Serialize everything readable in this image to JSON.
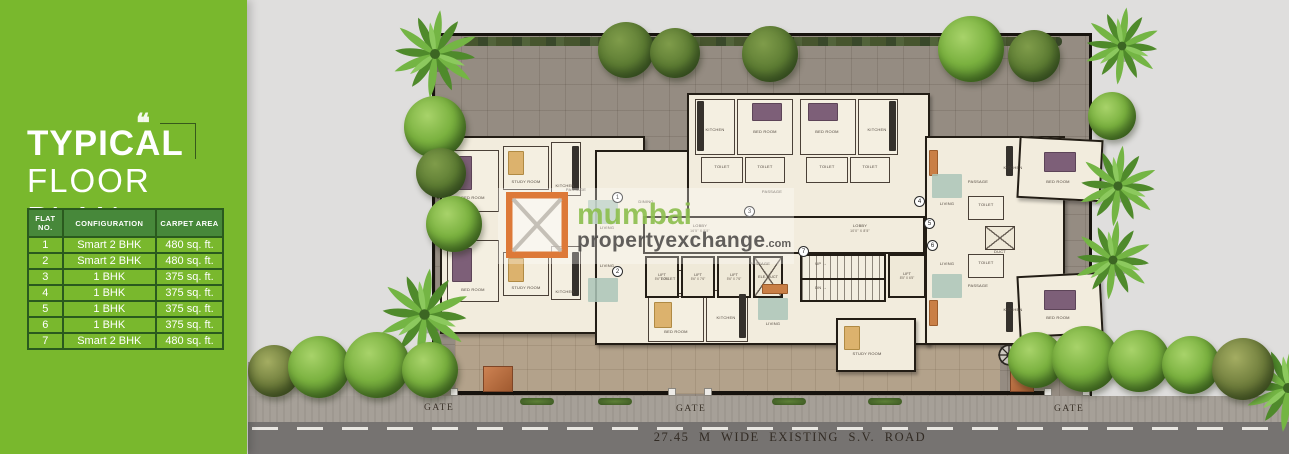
{
  "colors": {
    "panel_green": "#79b82d",
    "table_header_green": "#47883a",
    "table_border_green": "#2a5a1e",
    "watermark_green": "#8cbf4d",
    "watermark_gray": "#514f4c",
    "logo_orange": "#dd7938",
    "paving_gray": "#958c82",
    "plaza_beige": "#b3a28b",
    "road_gray": "#767371"
  },
  "left_panel": {
    "quote_glyph": "❝",
    "title_line1": "TYPICAL",
    "title_line2": "FLOOR PLAN",
    "table": {
      "headers": [
        "FLAT NO.",
        "CONFIGURATION",
        "CARPET AREA"
      ],
      "rows": [
        [
          "1",
          "Smart 2 BHK",
          "480 sq. ft."
        ],
        [
          "2",
          "Smart 2 BHK",
          "480 sq. ft."
        ],
        [
          "3",
          "1 BHK",
          "375 sq. ft."
        ],
        [
          "4",
          "1 BHK",
          "375 sq. ft."
        ],
        [
          "5",
          "1 BHK",
          "375 sq. ft."
        ],
        [
          "6",
          "1 BHK",
          "375 sq. ft."
        ],
        [
          "7",
          "Smart 2 BHK",
          "480 sq. ft."
        ]
      ]
    }
  },
  "watermark": {
    "brand": "mumbai",
    "brand2": "propertyexchange",
    "tld": ".com"
  },
  "plan": {
    "compass_label": "N",
    "gates": [
      "GATE",
      "GATE",
      "GATE"
    ],
    "road_label": "27.45 M WIDE EXISTING  S.V. ROAD",
    "flat_numbers": [
      "1",
      "2",
      "3",
      "4",
      "5",
      "6",
      "7"
    ],
    "room_labels": {
      "bed": "BED ROOM",
      "study": "STUDY ROOM",
      "kitchen": "KITCHEN",
      "living": "LIVING",
      "dining": "DINING",
      "toilet": "TOILET",
      "passage": "PASSAGE",
      "duct": "DUCT"
    },
    "core": {
      "lobby_a": "LOBBY",
      "lobby_a_dim": "16'5\" X 5'5\"",
      "lobby_b": "LOBBY",
      "lobby_b_dim": "10'0\" X 8'5\"",
      "lift": "LIFT",
      "lift_dim": "5'6\" X 7'6\"",
      "lift2": "LIFT",
      "lift2_dim": "8'5\" X 6'5\"",
      "ele_duct": "ELE. DUCT",
      "up": "UP",
      "dn": "DN"
    }
  }
}
